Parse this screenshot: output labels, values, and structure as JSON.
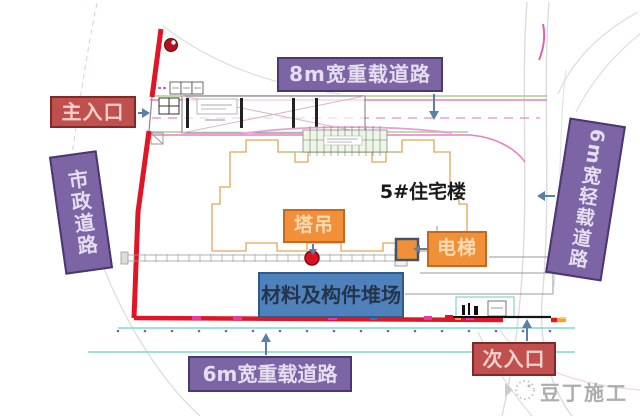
{
  "plan": {
    "building_label": "5#住宅楼",
    "labels": {
      "road_top": "8m宽重载道路",
      "road_bottom": "6m宽重载道路",
      "road_right": "6m宽轻载道路",
      "road_municipal": "市政道路",
      "entrance_main": "主入口",
      "entrance_secondary": "次入口",
      "tower_crane": "塔吊",
      "elevator": "电梯",
      "storage_yard": "材料及构件堆场"
    }
  },
  "watermark": {
    "text": "豆丁施工"
  },
  "colors": {
    "purple_label": "#7d64a5",
    "purple_border": "#4a3870",
    "red_label": "#c0504d",
    "red_border": "#7f2a28",
    "orange_label": "#f0913a",
    "orange_border": "#c86820",
    "blue_label": "#4f81bd",
    "blue_border": "#2f5a8a",
    "boundary_red": "#e01525",
    "arrow_blue": "#5b7fa6",
    "building_outline": "#dfa857",
    "cyan_line": "#7adbd4",
    "green_line": "#a8d08d",
    "magenta_line": "#e87fc4",
    "tower_crane_dot": "#dd1020"
  }
}
